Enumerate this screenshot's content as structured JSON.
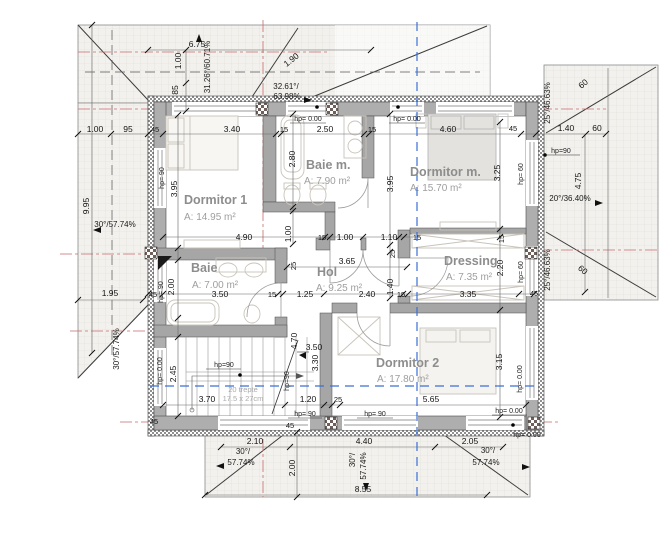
{
  "plan": {
    "rooms": [
      {
        "name": "Dormitor 1",
        "area": "A: 14.95 m²"
      },
      {
        "name": "Baie m.",
        "area": "A: 7.90 m²"
      },
      {
        "name": "Dormitor m.",
        "area": "A: 15.70 m²"
      },
      {
        "name": "Baie",
        "area": "A: 7.00 m²"
      },
      {
        "name": "Hol",
        "area": "A: 9.25 m²"
      },
      {
        "name": "Dressing",
        "area": "A: 7.35 m²"
      },
      {
        "name": "Dormitor 2",
        "area": "A: 17.80 m²"
      }
    ],
    "stairs": {
      "note1": "20 trepte",
      "note2": "17.5 x 27cm"
    },
    "hp": {
      "h90": "hp= 90",
      "h90c": "hp=90",
      "h0": "hp= 0.00",
      "h60": "hp= 60"
    },
    "dims": {
      "top": [
        "1.00",
        "95",
        "45",
        "3.40",
        "15",
        "2.50",
        "15",
        "4.60",
        "45",
        "1.40",
        "60"
      ],
      "offsets": [
        "6.75",
        "1.00",
        "85",
        "1.90"
      ],
      "rowA": [
        "4.90",
        "15",
        "1.00",
        "1.10",
        "15"
      ],
      "rowB": [
        "45",
        "3.50",
        "15",
        "1.25",
        "2.40",
        "15",
        "3.35",
        "45"
      ],
      "holWidth": "3.65",
      "rowC": [
        "3.70",
        "1.20",
        "25",
        "5.65"
      ],
      "vLeft": [
        "3.95",
        "2.00",
        "2.45",
        "9.95",
        "1.95"
      ],
      "vMid": [
        "2.80",
        "1.00",
        "3.95",
        "25",
        "1.40",
        "25",
        "4.70",
        "3.30",
        "3.50",
        "2.00"
      ],
      "vRight": [
        "3.25",
        "15",
        "2.20",
        "3.15",
        "4.75",
        "60",
        "60"
      ],
      "bottom": [
        "2.10",
        "4.40",
        "2.05",
        "8.55"
      ],
      "w45": "45"
    },
    "slopes": {
      "s30": "30°/57.74%",
      "s30a": "30°/",
      "s30b": "57.74%",
      "s3126": "31.26°/60.71%",
      "s3261a": "32.61°/",
      "s3261b": "63.98%",
      "s25": "25°/46.63%",
      "s20": "20°/36.40%"
    }
  }
}
